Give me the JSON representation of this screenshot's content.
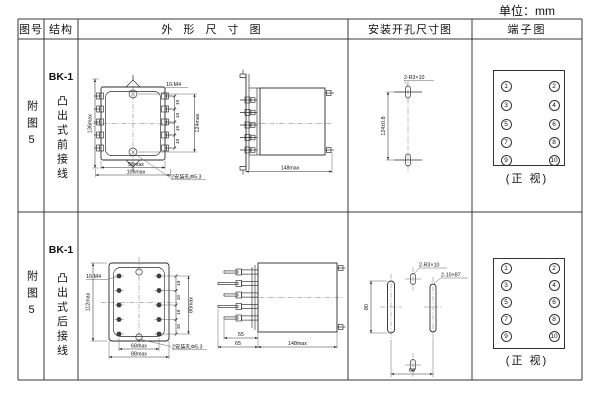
{
  "page": {
    "unit_label": "单位：mm"
  },
  "header": {
    "fig_no": "图号",
    "structure": "结构",
    "outline": "外 形 尺 寸 图",
    "mounting": "安装开孔尺寸图",
    "terminal": "端子图"
  },
  "rows": [
    {
      "fig_no": "附图5",
      "model": "BK-1",
      "structure": "凸出式前接线",
      "front_view": {
        "overall_height": "136max",
        "pitch": "19",
        "screw_span": "124max",
        "screw_spec": "10-M4",
        "inner_width": "98max",
        "outer_width": "106max",
        "mount_hole_note": "2安装孔Φ5.3"
      },
      "side_view": {
        "depth": "148max"
      },
      "mounting_view": {
        "slot_spec": "2-R3×10",
        "vertical_spacing": "124±0.8"
      },
      "terminal_view": {
        "left_pins": [
          "1",
          "3",
          "5",
          "7",
          "9"
        ],
        "right_pins": [
          "2",
          "4",
          "6",
          "8",
          "10"
        ],
        "caption": "(正 视)"
      }
    },
    {
      "fig_no": "附图5",
      "model": "BK-1",
      "structure": "凸出式后接线",
      "front_view": {
        "overall_height": "112max",
        "pitch": "19",
        "screw_span": "80max",
        "screw_spec": "10-M4",
        "inner_width": "68max",
        "outer_width": "88max",
        "mount_hole_note": "2安装孔Φ5.3"
      },
      "side_view": {
        "pin_inner": "55",
        "pin_outer": "65",
        "depth": "148max"
      },
      "mounting_view": {
        "slot_spec": "2-R3×10",
        "large_slot_spec": "2-10×87",
        "slot_height": "80",
        "horizontal_spacing": "68"
      },
      "terminal_view": {
        "left_pins": [
          "1",
          "3",
          "5",
          "7",
          "9"
        ],
        "right_pins": [
          "2",
          "4",
          "6",
          "8",
          "10"
        ],
        "caption": "(正 视)"
      }
    }
  ]
}
